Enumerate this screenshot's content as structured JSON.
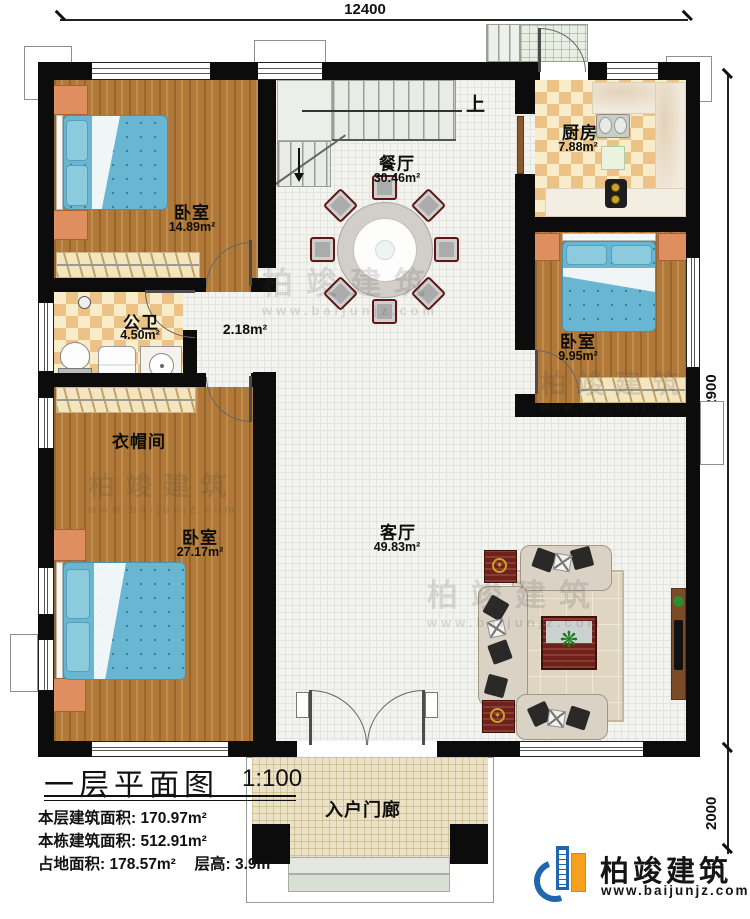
{
  "dims": {
    "top": "12400",
    "right_main": "12900",
    "right_porch": "2000"
  },
  "rooms": {
    "bedroom_tl": {
      "name": "卧室",
      "area": "14.89m²"
    },
    "dining": {
      "name": "餐厅",
      "area": "30.46m²"
    },
    "kitchen": {
      "name": "厨房",
      "area": "7.88m²"
    },
    "bathroom": {
      "name": "公卫",
      "area": "4.50m²"
    },
    "hall": {
      "area": "2.18m²"
    },
    "bedroom_r": {
      "name": "卧室",
      "area": "9.95m²"
    },
    "cloakroom": {
      "name": "衣帽间"
    },
    "bedroom_bl": {
      "name": "卧室",
      "area": "27.17m²"
    },
    "living": {
      "name": "客厅",
      "area": "49.83m²"
    },
    "porch": {
      "name": "入户门廊"
    }
  },
  "stairs": {
    "up_label": "上"
  },
  "title_block": {
    "title": "一层平面图",
    "scale": "1:100",
    "line1_label": "本层建筑面积:",
    "line1_value": "170.97m²",
    "line2_label": "本栋建筑面积:",
    "line2_value": "512.91m²",
    "line3_label": "占地面积:",
    "line3_value": "178.57m²",
    "line3b_label": "层高:",
    "line3b_value": "3.9m"
  },
  "brand": {
    "name": "柏竣建筑",
    "url": "www.baijunjz.com"
  },
  "watermark": {
    "text": "柏竣建筑",
    "url": "www.baijunjz.com"
  },
  "colors": {
    "wall": "#0c0c0c",
    "wood_floor": "#b0793a",
    "tile": "#f3f3f0",
    "checker_gold": "#ecc287",
    "bed_blue": "#68b6d1",
    "nightstand_orange": "#df8e5f",
    "furniture_red": "#6f211c",
    "brand_blue": "#1f66ad",
    "brand_orange": "#f6a01b"
  }
}
